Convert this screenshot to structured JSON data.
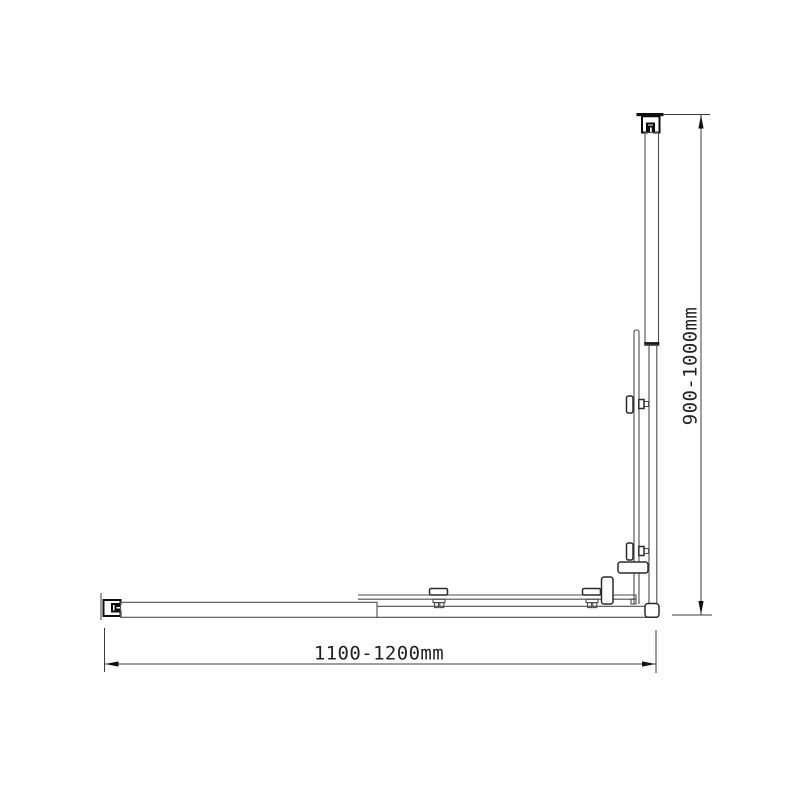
{
  "diagram": {
    "horizontal_dimension": {
      "label": "1100-1200mm"
    },
    "vertical_dimension": {
      "label": "900-1000mm"
    },
    "colors": {
      "background": "#ffffff",
      "line": "#4d4d4d",
      "outline_dark": "#0d0d0d",
      "dimension_line": "#3c3c3c",
      "dimension_text": "#222222"
    }
  }
}
